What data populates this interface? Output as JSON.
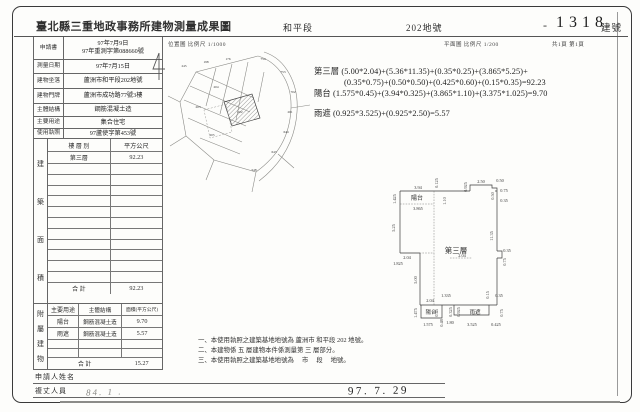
{
  "colors": {
    "paper": "#fdfdfb",
    "ink": "#2f2f2f",
    "line": "#666666"
  },
  "header": {
    "title": "臺北縣三重地政事務所建物測量成果圖",
    "section": "和平段",
    "parcel": "202地號",
    "building_no_dash": "-",
    "building_no": "1318",
    "building_no_label": "建號"
  },
  "subheader": {
    "location_scale": "位置圖 比例尺 1/1000",
    "plan_scale": "平面圖 比例尺 1/200",
    "page_count": "共1頁 第1頁"
  },
  "form": {
    "rows": [
      {
        "label": "申請書",
        "value": "97年7月9日",
        "value2": "97年重測字第088660號"
      },
      {
        "label": "測量日期",
        "value": "97年7月15日"
      },
      {
        "label": "建物坐落",
        "value": "蘆洲市和平段202地號"
      },
      {
        "label": "建物門牌",
        "value": "蘆洲市成功路77號3樓"
      },
      {
        "label": "主體結構",
        "value": "鋼筋混凝土造"
      },
      {
        "label": "主要用途",
        "value": "集合住宅"
      },
      {
        "label": "使用執照",
        "value": "97蘆使字第453號"
      }
    ]
  },
  "side_captions": {
    "building_area": "建築面積",
    "attached": "附屬建物"
  },
  "area_table": {
    "floor_header": "樓 層 別",
    "area_header": "平方公尺",
    "floor": "第三層",
    "area": "92.23",
    "total_label": "合  計",
    "total": "92.23"
  },
  "attached_table": {
    "use_header": "主要用途",
    "structure_header": "主體結構",
    "area_header": "面積(平方公尺)",
    "rows": [
      {
        "use": "陽台",
        "structure": "鋼筋混凝土造",
        "area": "9.70"
      },
      {
        "use": "雨遮",
        "structure": "鋼筋混凝土造",
        "area": "5.57"
      }
    ],
    "total_label": "合  計",
    "total": "15.27"
  },
  "formulas": {
    "line1": "第三層 (5.00*2.04)+(5.36*11.35)+(0.35*0.25)+(3.865*5.25)+",
    "line2": "(0.35*0.75)+(0.50*0.50)+(0.425*0.60)+(0.15*0.35)=92.23",
    "line3": "陽台 (1.575*0.45)+(3.94*0.325)+(3.865*1.10)+(3.375*1.025)=9.70",
    "line4": "雨遮 (0.925*3.525)+(0.925*2.50)=5.57"
  },
  "notes": {
    "line1": "一、本使用執照之建築基地地號為 蘆洲市 和平段  202 地號。",
    "line2": "二、本建物係 五 層建物本件係測量第 三 層部分。",
    "line3": "三、本使用執照之建築基地地號為　 市　 段　  地號。"
  },
  "signature": {
    "applicant_label": "申請人姓名",
    "surveyor_label": "複丈人員",
    "date_stamp": "97. 7. 29",
    "handwriting": "84. 1 ."
  },
  "floor_plan": {
    "dims": [
      {
        "t": "3.94",
        "x": 28,
        "y": 21,
        "r": 0
      },
      {
        "t": "1.425",
        "x": 6,
        "y": 31,
        "r": -90
      },
      {
        "t": "陽台",
        "x": 27,
        "y": 32,
        "r": 0,
        "s": 6,
        "n": "room-label"
      },
      {
        "t": "3.865",
        "x": 28,
        "y": 42,
        "r": 0
      },
      {
        "t": "5.25",
        "x": 5,
        "y": 60,
        "r": -90
      },
      {
        "t": "0.125",
        "x": 48,
        "y": 15,
        "r": -90
      },
      {
        "t": "1.10",
        "x": 56,
        "y": 33,
        "r": -90
      },
      {
        "t": "0.925",
        "x": 77,
        "y": 19,
        "r": -90
      },
      {
        "t": "2.50",
        "x": 91,
        "y": 15,
        "r": 0
      },
      {
        "t": "0.50",
        "x": 110,
        "y": 14,
        "r": 0
      },
      {
        "t": "0.50",
        "x": 104,
        "y": 28,
        "r": -90
      },
      {
        "t": "0.75",
        "x": 114,
        "y": 24,
        "r": 0
      },
      {
        "t": "0.35",
        "x": 114,
        "y": 34,
        "r": 0
      },
      {
        "t": "11.35",
        "x": 103,
        "y": 68,
        "r": -90
      },
      {
        "t": "第三層",
        "x": 66,
        "y": 85,
        "r": 0,
        "s": 7.5,
        "n": "room-label"
      },
      {
        "t": "2.04",
        "x": 72,
        "y": 89,
        "r": 0
      },
      {
        "t": "2.04",
        "x": 17,
        "y": 91,
        "r": 0
      },
      {
        "t": "1.825",
        "x": 8,
        "y": 97,
        "r": 0
      },
      {
        "t": "5.00",
        "x": 27,
        "y": 112,
        "r": -90
      },
      {
        "t": "0.35",
        "x": 117,
        "y": 84,
        "r": 0
      },
      {
        "t": "0.75",
        "x": 116,
        "y": 94,
        "r": -90
      },
      {
        "t": "2.04",
        "x": 40,
        "y": 134,
        "r": 0
      },
      {
        "t": "1.335",
        "x": 56,
        "y": 129,
        "r": 0
      },
      {
        "t": "1.475",
        "x": 27,
        "y": 145,
        "r": -90
      },
      {
        "t": "陽台",
        "x": 41,
        "y": 146,
        "r": 0,
        "s": 5.5,
        "n": "room-label"
      },
      {
        "t": "0.45",
        "x": 48,
        "y": 145,
        "r": -90
      },
      {
        "t": "1.575",
        "x": 38,
        "y": 158,
        "r": 0
      },
      {
        "t": "0.48",
        "x": 53,
        "y": 155,
        "r": -90
      },
      {
        "t": "1.80",
        "x": 60,
        "y": 156,
        "r": 0
      },
      {
        "t": "0.325",
        "x": 62,
        "y": 144,
        "r": -90
      },
      {
        "t": "0.925",
        "x": 70,
        "y": 144,
        "r": -90
      },
      {
        "t": "雨遮",
        "x": 85,
        "y": 146,
        "r": 0,
        "s": 5.5,
        "n": "room-label"
      },
      {
        "t": "3.525",
        "x": 82,
        "y": 158,
        "r": 0
      },
      {
        "t": "0.15",
        "x": 99,
        "y": 127,
        "r": -90
      },
      {
        "t": "0.35",
        "x": 109,
        "y": 129,
        "r": 0
      },
      {
        "t": "0.75",
        "x": 113,
        "y": 145,
        "r": -90
      },
      {
        "t": "0.425",
        "x": 106,
        "y": 158,
        "r": 0
      }
    ]
  },
  "site_map": {
    "numbers": [
      {
        "t": "245",
        "x": 18,
        "y": 17
      },
      {
        "t": "198",
        "x": 40,
        "y": 13
      },
      {
        "t": "176",
        "x": 62,
        "y": 10
      },
      {
        "t": "754",
        "x": 97,
        "y": 10
      },
      {
        "t": "753",
        "x": 117,
        "y": 23
      },
      {
        "t": "702",
        "x": 127,
        "y": 43
      },
      {
        "t": "201",
        "x": 124,
        "y": 63
      },
      {
        "t": "644",
        "x": 120,
        "y": 83
      },
      {
        "t": "643",
        "x": 108,
        "y": 103
      },
      {
        "t": "548",
        "x": 88,
        "y": 121
      },
      {
        "t": "204",
        "x": 50,
        "y": 38
      },
      {
        "t": "203",
        "x": 32,
        "y": 58
      },
      {
        "t": "202",
        "x": 74,
        "y": 63
      },
      {
        "t": "205",
        "x": 46,
        "y": 86
      }
    ]
  }
}
